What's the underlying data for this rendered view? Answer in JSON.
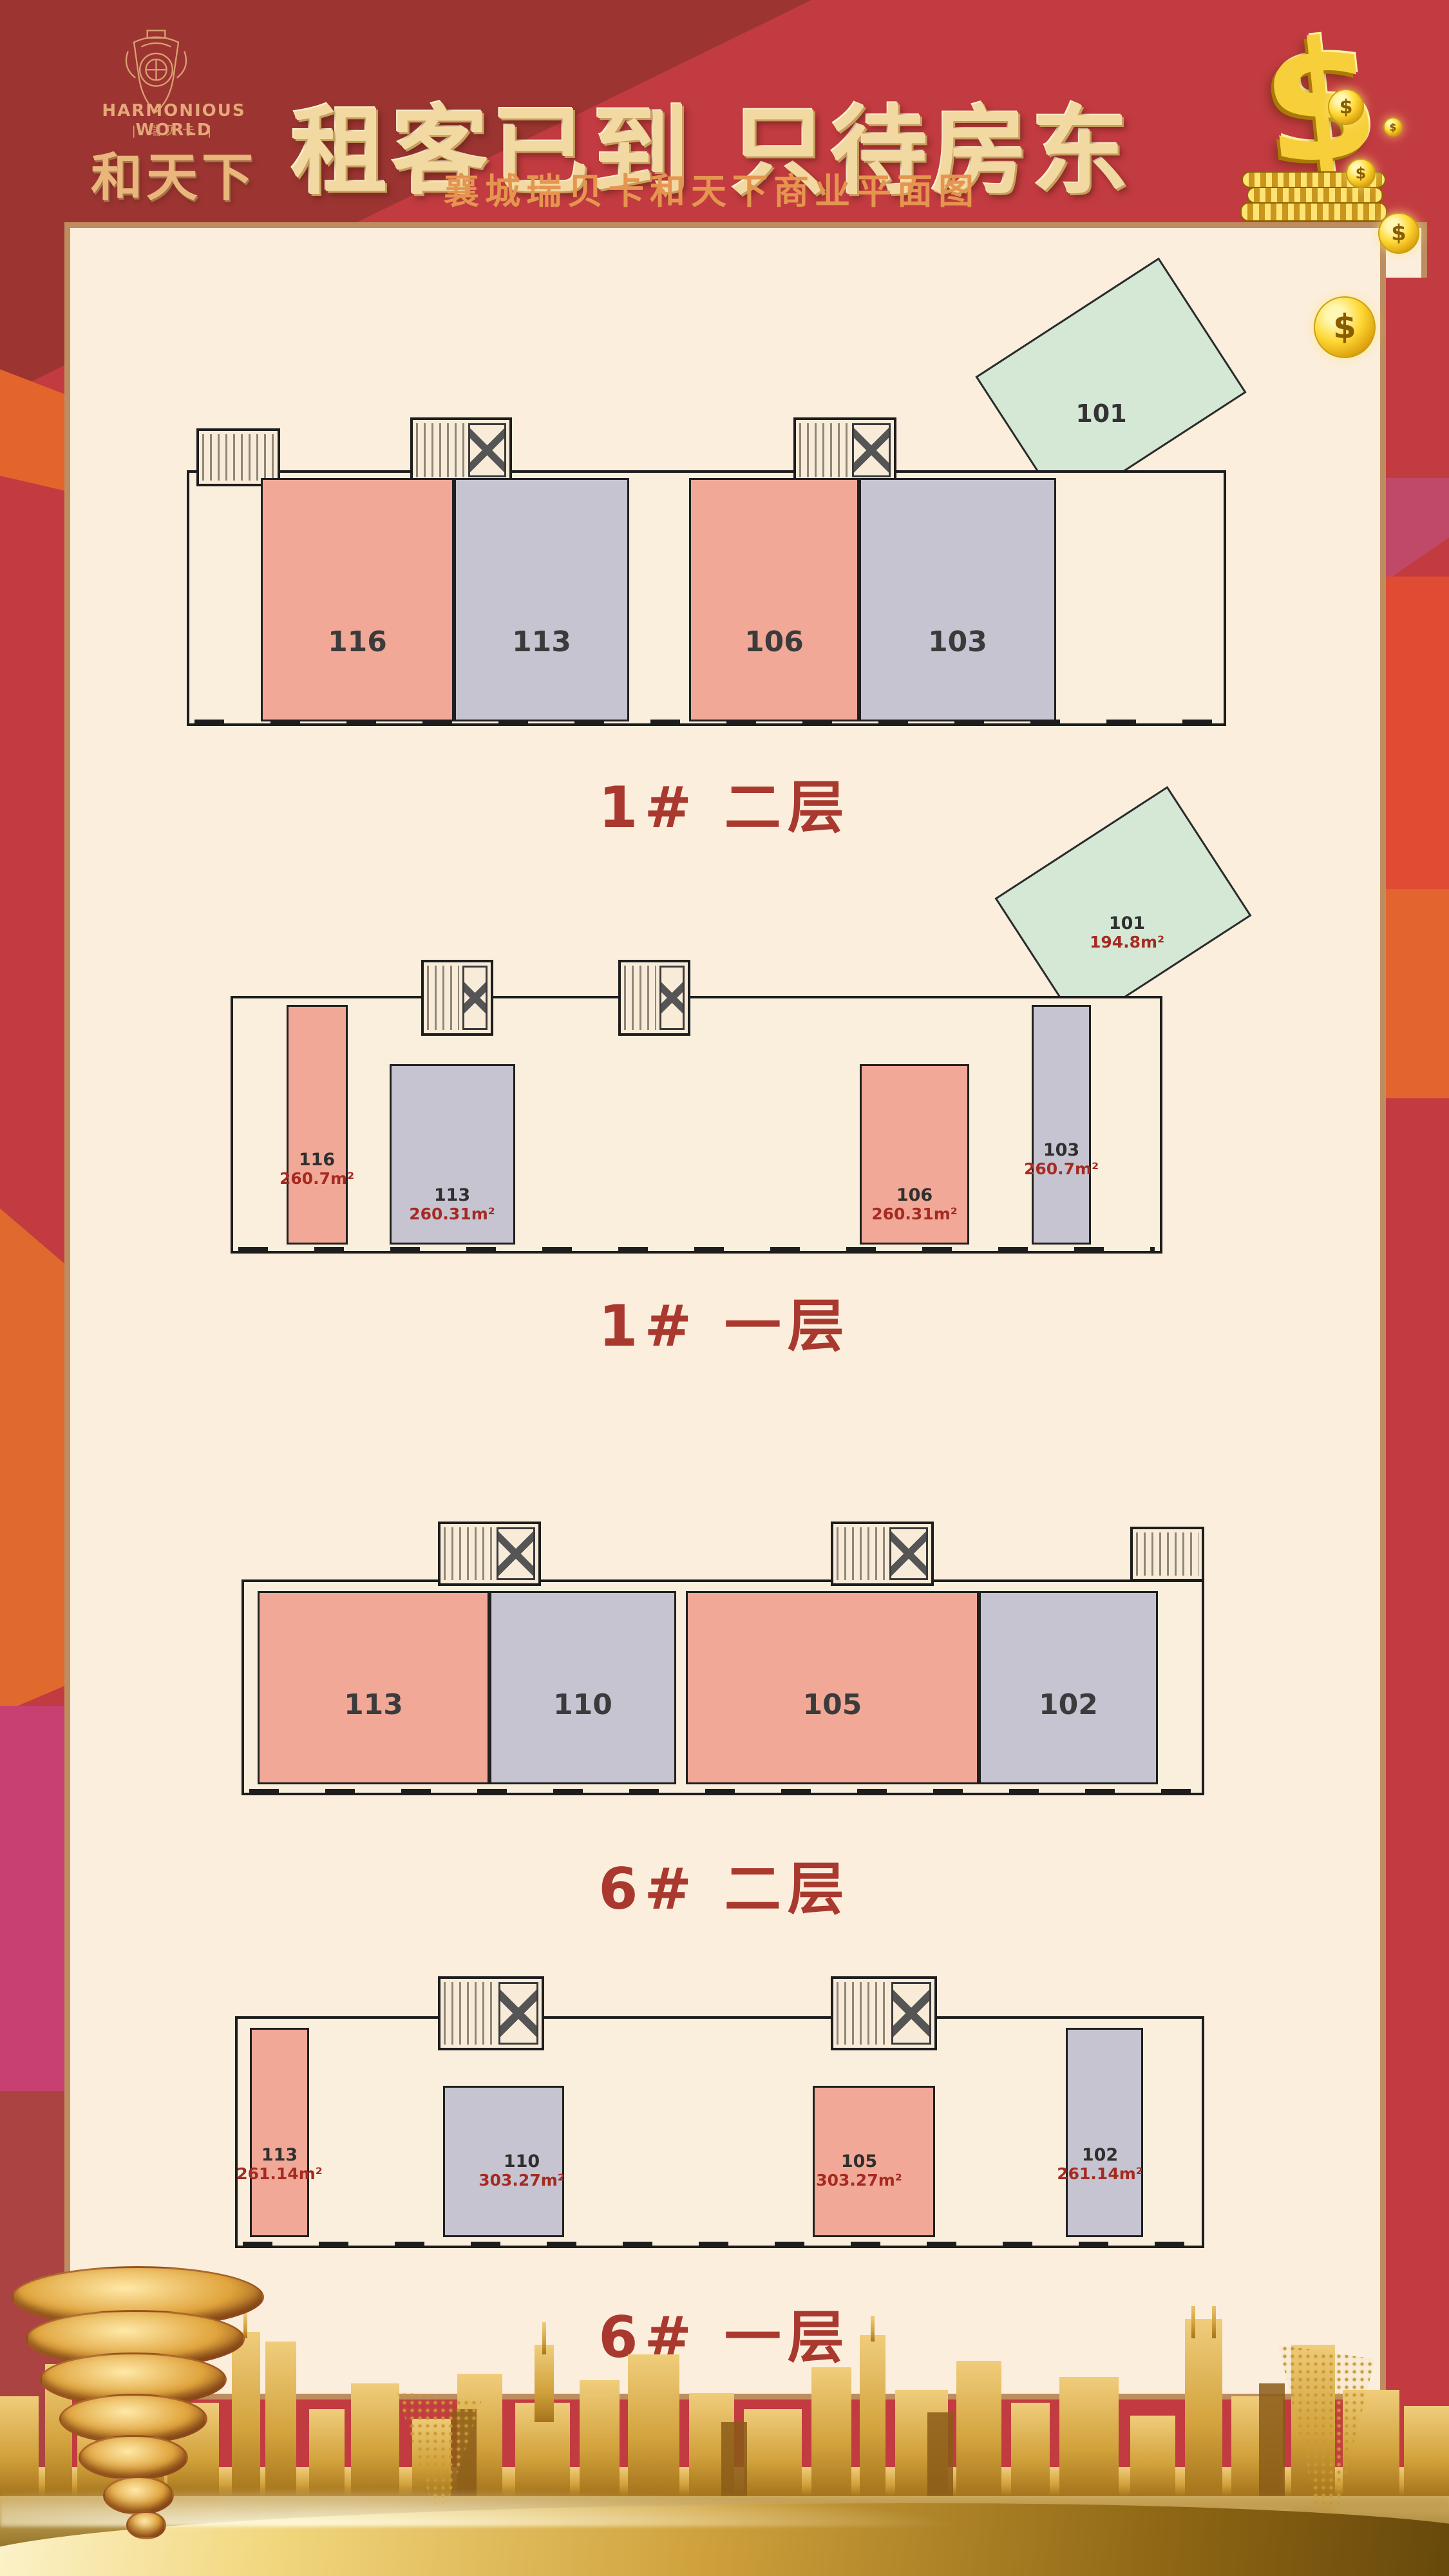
{
  "poster": {
    "brand": {
      "name_en": "HARMONIOUS WORLD",
      "name_cn_small": "| 瑞贝卡 |",
      "name_cn": "和天下"
    },
    "header": {
      "title": "租客已到 只待房东",
      "subtitle": "襄城瑞贝卡和天下商业平面图"
    },
    "money": {
      "dollar_symbol": "$"
    },
    "plans": [
      {
        "label": "1# 二层",
        "units": [
          {
            "no": "116"
          },
          {
            "no": "113"
          },
          {
            "no": "106"
          },
          {
            "no": "103"
          },
          {
            "no": "101"
          }
        ]
      },
      {
        "label": "1# 一层",
        "units": [
          {
            "no": "116",
            "area": "260.7m²"
          },
          {
            "no": "113",
            "area": "260.31m²"
          },
          {
            "no": "106",
            "area": "260.31m²"
          },
          {
            "no": "103",
            "area": "260.7m²"
          },
          {
            "no": "101",
            "area": "194.8m²"
          }
        ]
      },
      {
        "label": "6# 二层",
        "units": [
          {
            "no": "113"
          },
          {
            "no": "110"
          },
          {
            "no": "105"
          },
          {
            "no": "102"
          }
        ]
      },
      {
        "label": "6# 一层",
        "units": [
          {
            "no": "113",
            "area": "261.14m²"
          },
          {
            "no": "110",
            "area": "303.27m²"
          },
          {
            "no": "105",
            "area": "303.27m²"
          },
          {
            "no": "102",
            "area": "261.14m²"
          }
        ]
      }
    ],
    "legend_colors": {
      "unit_pink": "#f1a897",
      "unit_gray": "#c6c4d0",
      "unit_green": "#d4e8d5",
      "background_red": "#c23b40",
      "panel_cream": "#fbeedd",
      "panel_border_tan": "#bf8c5f",
      "plan_label_red": "#a9392f",
      "title_gold": "#f2d9a2",
      "subtitle_gold": "#e5954f"
    }
  }
}
